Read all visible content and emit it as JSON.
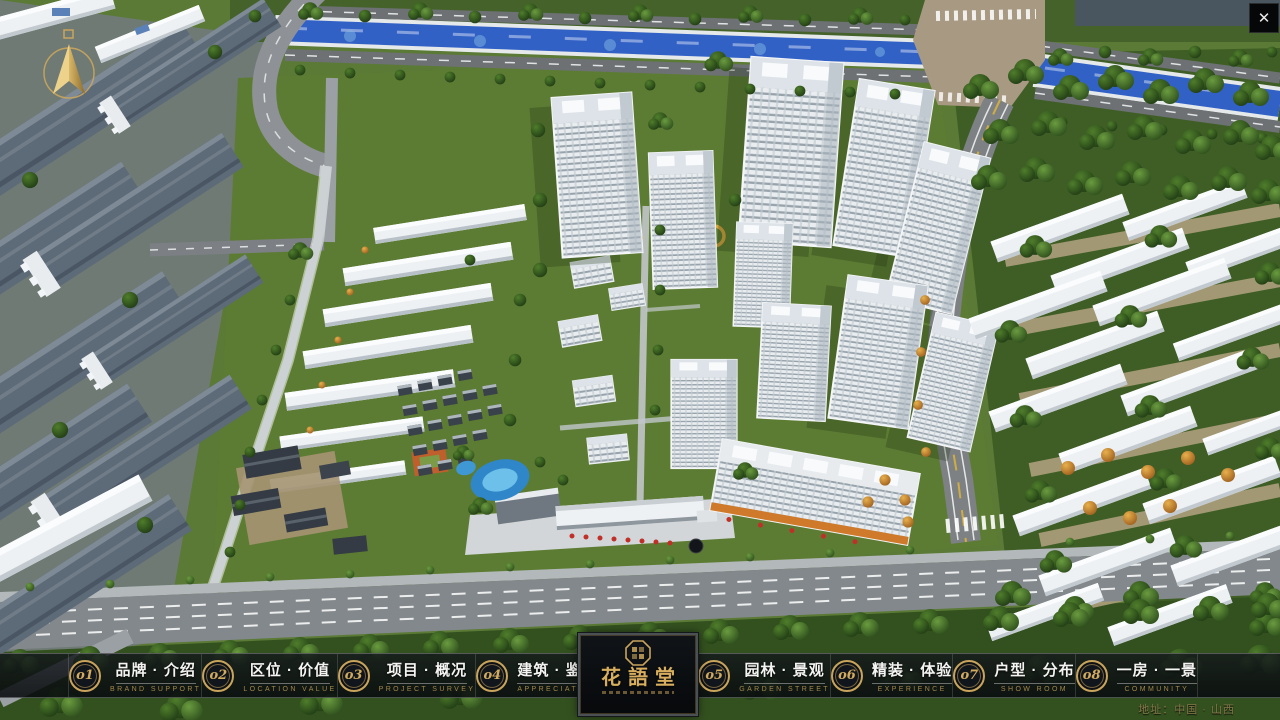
{
  "window": {
    "close_icon": "✕"
  },
  "nav": {
    "items": [
      {
        "num": "o1",
        "zh": "品牌 · 介绍",
        "en": "BRAND SUPPORT"
      },
      {
        "num": "o2",
        "zh": "区位 · 价值",
        "en": "LOCATION VALUE"
      },
      {
        "num": "o3",
        "zh": "项目 · 概况",
        "en": "PROJECT SURVEY"
      },
      {
        "num": "o4",
        "zh": "建筑 · 鉴赏",
        "en": "APPRECIATION"
      },
      {
        "num": "o5",
        "zh": "园林 · 景观",
        "en": "GARDEN STREET"
      },
      {
        "num": "o6",
        "zh": "精装 · 体验",
        "en": "EXPERIENCE"
      },
      {
        "num": "o7",
        "zh": "户型 · 分布",
        "en": "SHOW ROOM"
      },
      {
        "num": "o8",
        "zh": "一房 · 一景",
        "en": "COMMUNITY"
      }
    ]
  },
  "logo": {
    "title": "花語堂",
    "seal_icon": "octagon-seal-icon"
  },
  "footer": {
    "address": "地址：中国 · 山西"
  },
  "icons": {
    "compass": "north-compass-icon",
    "close": "close-icon"
  },
  "colors": {
    "gold": "#c9a45c",
    "gold_dim": "#a2874c",
    "bar_bg": "rgba(10,13,16,0.85)",
    "text": "#f4f4f2",
    "river": "#3261c6",
    "grass": "#5a7a35"
  }
}
